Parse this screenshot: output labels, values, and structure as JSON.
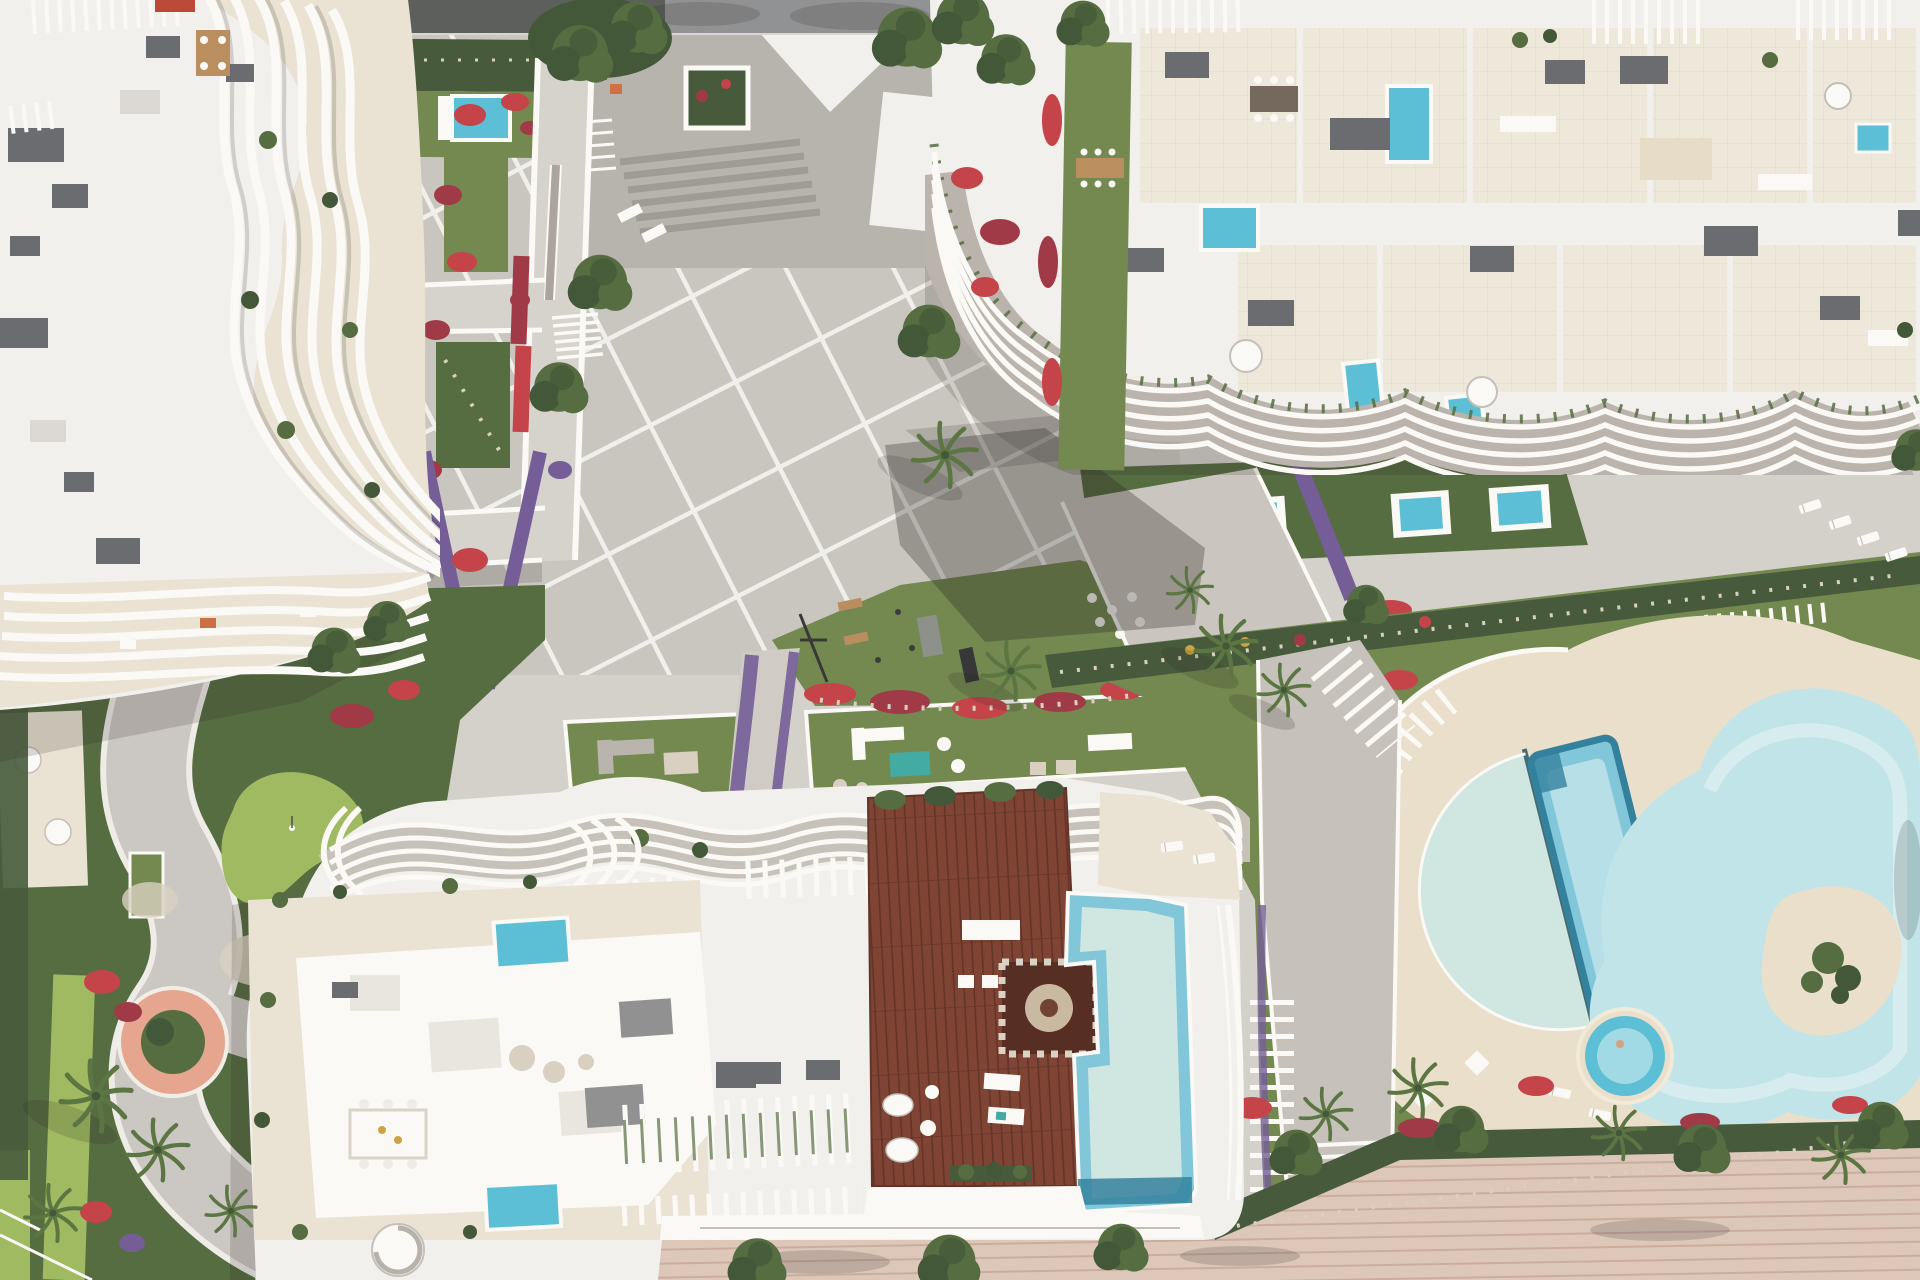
{
  "palette": {
    "base": "#d3cfca",
    "plaza": "#c8c4bf",
    "plaza_line": "#f2f0ec",
    "courtyard": "#b5b1ab",
    "road": "#8d8e91",
    "white": "#f3f1ee",
    "white_bright": "#fbfaf7",
    "white_shade": "#c2beb8",
    "cream": "#eae3d3",
    "sand": "#eadfca",
    "tile": "#efe8db",
    "tile_line": "#e3d9c6",
    "wood": "#7a3c2c",
    "wood_dark": "#5c2a1f",
    "deck_table": "#b98a5a",
    "grass": "#6d8449",
    "grass_shade": "#4f6639",
    "grass_bright": "#9cb85c",
    "hedge": "#3f5434",
    "tree": "#4e6639",
    "tree_dark": "#3a5130",
    "palm": "#55703c",
    "pool_pale": "#cfe6e2",
    "pool_blue": "#7cc6da",
    "pool_deep": "#2b7c9b",
    "pool_plunge": "#56bdd5",
    "pool_free": "#bfe4ea",
    "pool_light": "#e4f4f5",
    "flower_red": "#9e3140",
    "flower_crimson": "#c23b42",
    "flower_purple": "#6f5794",
    "flower_rose": "#c96a80",
    "gravel": "#d8cfc0",
    "box": "#64666b",
    "pink_patio": "#e5a28b",
    "beach": "#dcc6b8",
    "beach_line": "#c9aa9c",
    "teal": "#3aa89f",
    "shadow": "rgba(30,26,22,0.30)",
    "shadow_soft": "rgba(30,26,22,0.17)",
    "accent_red": "#b8412f"
  },
  "scene": {
    "title": "Aerial top-down architectural rendering of a white luxury residential resort with pools, plaza and gardens",
    "lighting": "sunny day, shadows cast toward the south-west",
    "buildings": {
      "north_west": {
        "label": "Apartment block with sculpted curved white balcony fins",
        "rooftop": [
          "air-conditioning units",
          "slatted pergolas",
          "wooden dining table",
          "red pergola detail"
        ],
        "terraces": [
          "cream balcony terraces between fins",
          "lounge furniture"
        ]
      },
      "north_east": {
        "label": "Apartment block with stacked wavy balcony bands",
        "rooftop": [
          "tiled penthouse terraces",
          "plunge pools",
          "lounge furniture",
          "spiral stairs",
          "slatted pergolas",
          "dining table"
        ],
        "garden": [
          "private lawn strip with dining table",
          "row of three private plunge pools",
          "crimson flower beds"
        ]
      },
      "south_central": {
        "label": "Apartment block with wavy pergola roofline",
        "rooftop": [
          "hardwood sun deck",
          "infinity pool",
          "shade cabana with round table",
          "two plunge pools",
          "outdoor dining table",
          "spiral staircase",
          "slatted pergolas with climbing plants",
          "sun loungers",
          "white organic loungers"
        ]
      }
    },
    "pool_complex": {
      "label": "Resort pool deck on a circular sand-coloured terrace",
      "pools": [
        "crescent reflection pool",
        "rectangular turquoise lap pool",
        "freeform lagoon pool with planted sand island",
        "small round kids pool"
      ],
      "features": [
        "white pergola trellis walk",
        "sun loungers",
        "parasols",
        "red flower borders",
        "palm trees"
      ]
    },
    "plaza": {
      "label": "Central paved plaza with diagonal white paving grid",
      "features": [
        "olive trees",
        "palm trees",
        "stairs",
        "water-channel walkway",
        "two footbridges to the west building",
        "square hedge planter",
        "outdoor gym lawn",
        "two walled garden lounges with sofas",
        "purple and crimson flower drifts",
        "paver path with dot pavers"
      ]
    },
    "west_garden": {
      "label": "Winding garden park",
      "features": [
        "putting green",
        "curved grey path",
        "circular coral-pink patio with shrub",
        "lime lawn strips",
        "palm cluster",
        "flower beds",
        "small white patio with parasols"
      ]
    },
    "promenade": {
      "label": "Pink-toned boardwalk along the bottom edge",
      "features": [
        "street trees",
        "dense hedge border",
        "access steps"
      ]
    },
    "road": {
      "label": "Grey access road along the top edge, partly shaded by trees"
    },
    "pools_total_visible": 16
  }
}
